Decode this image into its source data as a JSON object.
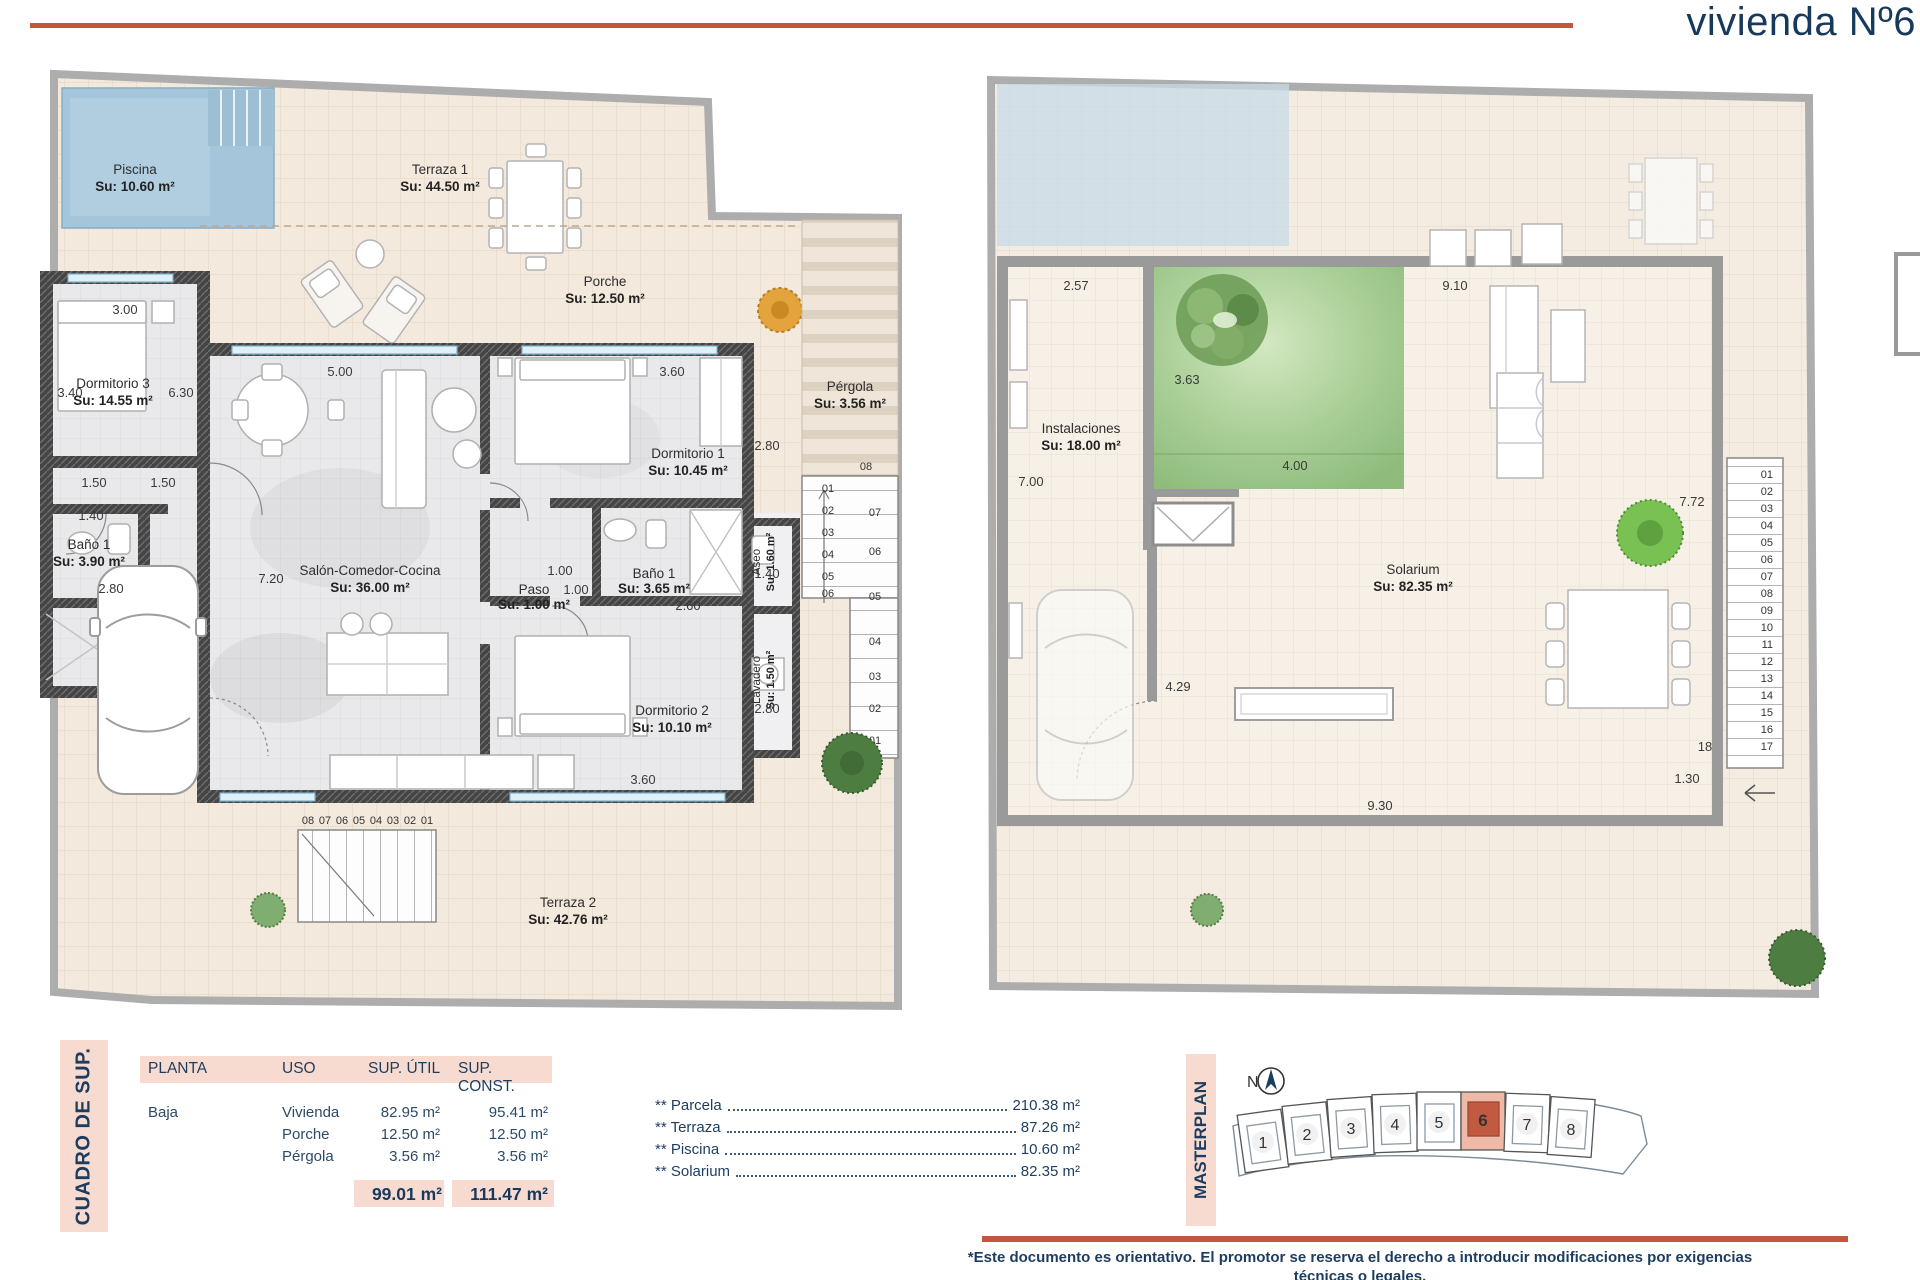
{
  "header": {
    "title": "vivienda Nº6"
  },
  "left": {
    "rooms": {
      "piscina": {
        "n": "Piscina",
        "a": "Su: 10.60 m²"
      },
      "terraza1": {
        "n": "Terraza 1",
        "a": "Su: 44.50 m²"
      },
      "porche": {
        "n": "Porche",
        "a": "Su: 12.50 m²"
      },
      "pergola": {
        "n": "Pérgola",
        "a": "Su: 3.56 m²"
      },
      "dorm3": {
        "n": "Dormitorio 3",
        "a": "Su: 14.55 m²"
      },
      "bano1l": {
        "n": "Baño 1",
        "a": "Su: 3.90 m²"
      },
      "salon": {
        "n": "Salón-Comedor-Cocina",
        "a": "Su: 36.00 m²"
      },
      "dorm1": {
        "n": "Dormitorio 1",
        "a": "Su: 10.45 m²"
      },
      "paso": {
        "n": "Paso",
        "a": "Su: 1.00 m²"
      },
      "bano1r": {
        "n": "Baño 1",
        "a": "Su: 3.65 m²"
      },
      "aseo": {
        "n": "Aseo",
        "a": "Su: 1.60 m²"
      },
      "dorm2": {
        "n": "Dormitorio 2",
        "a": "Su: 10.10 m²"
      },
      "lavadero": {
        "n": "Lavadero",
        "a": "Su: 1.50 m²"
      },
      "terraza2": {
        "n": "Terraza 2",
        "a": "Su: 42.76 m²"
      }
    },
    "dims": {
      "d3w": "3.00",
      "d3h": "3.40",
      "d3r": "6.30",
      "h1": "1.50",
      "h2": "1.50",
      "bw": "1.40",
      "bh": "2.80",
      "sh": "7.20",
      "sw": "5.00",
      "d1w": "3.60",
      "d1h": "2.80",
      "p1": "1.00",
      "p2": "1.00",
      "b2w": "2.60",
      "b2h": "1.40",
      "d2h": "2.80",
      "d2w": "3.60"
    },
    "stairs_bottom": [
      "08",
      "07",
      "06",
      "05",
      "04",
      "03",
      "02",
      "01"
    ],
    "stairs_right_top": "08",
    "stairs_inner": [
      "01",
      "02",
      "03",
      "04",
      "05",
      "06"
    ],
    "stairs_outer": [
      "07",
      "06",
      "05",
      "04",
      "03",
      "02",
      "01"
    ]
  },
  "right": {
    "rooms": {
      "instalaciones": {
        "n": "Instalaciones",
        "a": "Su: 18.00 m²"
      },
      "solarium": {
        "n": "Solarium",
        "a": "Su: 82.35 m²"
      }
    },
    "dims": {
      "a": "2.57",
      "b": "9.10",
      "c": "3.63",
      "d": "7.00",
      "e": "4.00",
      "f": "7.72",
      "g": "4.29",
      "h": "9.30",
      "i": "1.30",
      "j": "18"
    },
    "stairs": [
      "01",
      "02",
      "03",
      "04",
      "05",
      "06",
      "07",
      "08",
      "09",
      "10",
      "11",
      "12",
      "13",
      "14",
      "15",
      "16",
      "17"
    ]
  },
  "table": {
    "side_label": "CUADRO DE SUP.",
    "headers": [
      "PLANTA",
      "USO",
      "SUP. ÚTIL",
      "SUP. CONST."
    ],
    "planta": "Baja",
    "rows": [
      {
        "uso": "Vivienda",
        "util": "82.95 m²",
        "cons": "95.41 m²"
      },
      {
        "uso": "Porche",
        "util": "12.50 m²",
        "cons": "12.50 m²"
      },
      {
        "uso": "Pérgola",
        "util": "3.56 m²",
        "cons": "3.56 m²"
      }
    ],
    "total_util": "99.01 m²",
    "total_const": "111.47 m²"
  },
  "extras": [
    {
      "label": "** Parcela",
      "value": "210.38 m²"
    },
    {
      "label": "** Terraza",
      "value": "87.26 m²"
    },
    {
      "label": "** Piscina",
      "value": "10.60 m²"
    },
    {
      "label": "** Solarium",
      "value": "82.35 m²"
    }
  ],
  "masterplan": {
    "side_label": "MASTERPLAN",
    "north": "N",
    "units": [
      "1",
      "2",
      "3",
      "4",
      "5",
      "6",
      "7",
      "8"
    ],
    "highlighted": "6"
  },
  "disclaimer": {
    "es": "*Este documento es orientativo. El promotor se reserva el derecho a introducir modificaciones por exigencias técnicas o legales.",
    "en": "This document is indicative. The promoter reserves the right to introduce modifications due to technical or legal requirements."
  }
}
